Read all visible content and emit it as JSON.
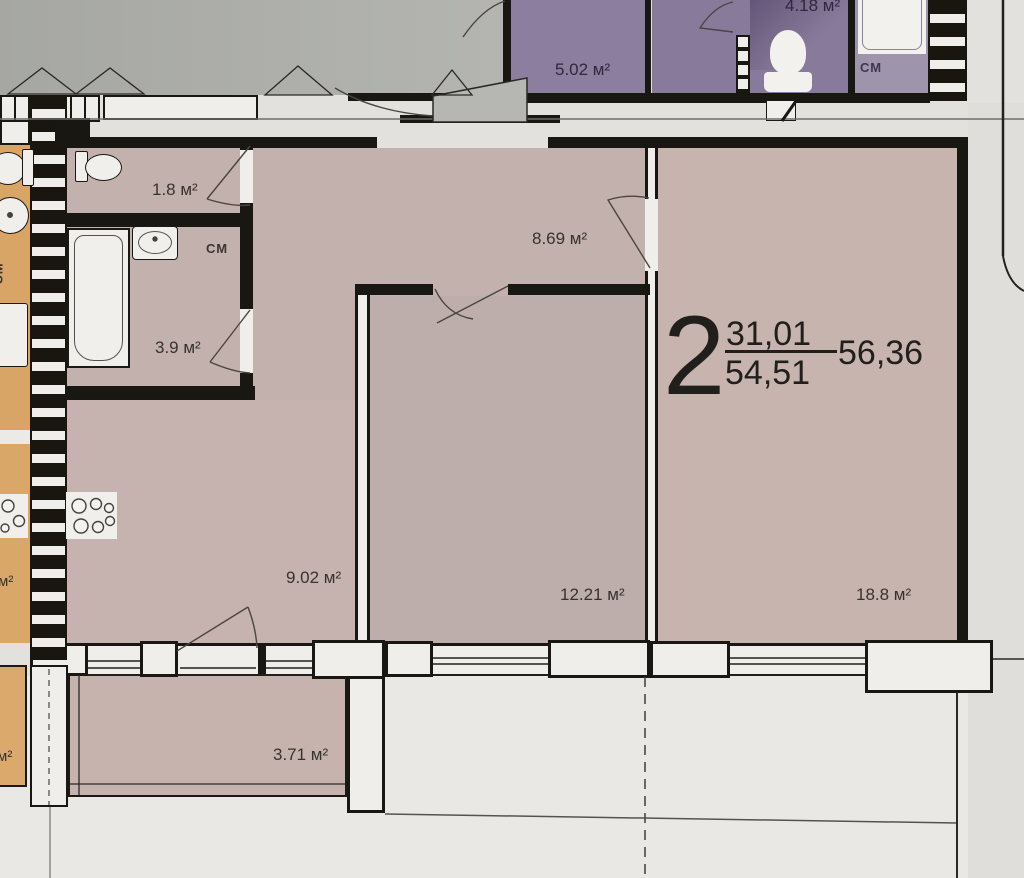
{
  "plan": {
    "apartment": {
      "summary": {
        "rooms_count": "2",
        "living_area": "31,01",
        "total_area": "54,51",
        "total_with_balcony": "56,36"
      },
      "rooms": {
        "hallway": {
          "label": "8.69 м²"
        },
        "kitchen": {
          "label": "9.02 м²"
        },
        "bedroom": {
          "label": "12.21 м²"
        },
        "living_room": {
          "label": "18.8 м²"
        },
        "bathroom": {
          "label": "3.9 м²",
          "cm_label": "СМ"
        },
        "wc": {
          "label": "1.8 м²"
        },
        "balcony": {
          "label": "3.71 м²"
        }
      }
    },
    "neighbor_upper": {
      "rooms": {
        "room": {
          "label": "5.02 м²"
        },
        "wc": {
          "label": "4.18 м²"
        },
        "bathroom": {
          "cm_label": "СМ"
        }
      }
    },
    "neighbor_left": {
      "cm_label": "СМ",
      "partial_label_mid": "м²",
      "partial_label_bottom": "м²"
    },
    "colors": {
      "room_fill": "#c3b1ad",
      "bedroom_fill": "#bdadab",
      "living_fill": "#c7b4ae",
      "purple_fill": "#8c7e9e",
      "purple_bath_fill": "#9e94ab",
      "orange_fill": "#d8a566",
      "wall": "#191712",
      "fixture_fill": "#f0efec",
      "background": "#e3e1dd",
      "gray_lobby": "#aaaba7"
    },
    "icons": [
      "toilet-icon",
      "bathtub-icon",
      "sink-icon",
      "stove-icon",
      "washing-machine-icon",
      "door-swing-arc"
    ]
  }
}
